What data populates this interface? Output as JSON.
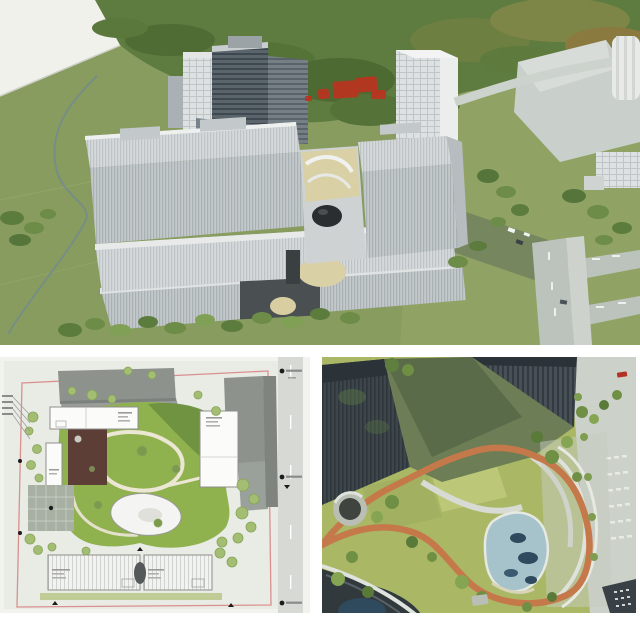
{
  "image": {
    "kind": "architectural rendering collage, three panels, no legible text",
    "watermark_note": "illegible red overprint marks on upper rendering"
  },
  "panels": {
    "aerial": {
      "label": "aerial-masterplan-rendering",
      "description": "Bird's-eye rendering of a white louvered twin-slab office complex on a shared podium amid green fields, a forest belt, background towers and roads; small red illegible watermark marks over the trees."
    },
    "site_plan": {
      "label": "site-plan-drawing",
      "description": "Colored site plan: pink property boundary, perimeter white buildings with tiny illegible labels, central free-form green courtyard with looping paths and a curved pavilion, sports court, east road strip with survey markers."
    },
    "courtyard": {
      "label": "courtyard-aerial-rendering",
      "description": "Aerial rendering of a landscaped court between dark glass towers: lawn, orange running loop, kidney-shaped pond, white terraces, circular sunken plaza and curved glass-roof building."
    }
  },
  "palette": {
    "field_green": "#879c5e",
    "forest_green": "#55713a",
    "facade_light": "#d6d9da",
    "facade_dark": "#4a545c",
    "road_gray": "#bcc3bd",
    "watermark_red": "#c0311f",
    "plan_background": "#eaece6",
    "boundary_pink": "#d9908f",
    "courtyard_green": "#8fb24f",
    "track_orange": "#c5794a",
    "pond_blue": "#a6c2cb",
    "glass_tower_dark": "#3d464b",
    "lawn_green": "#aab866",
    "terrace_beige": "#d9d0a6"
  }
}
